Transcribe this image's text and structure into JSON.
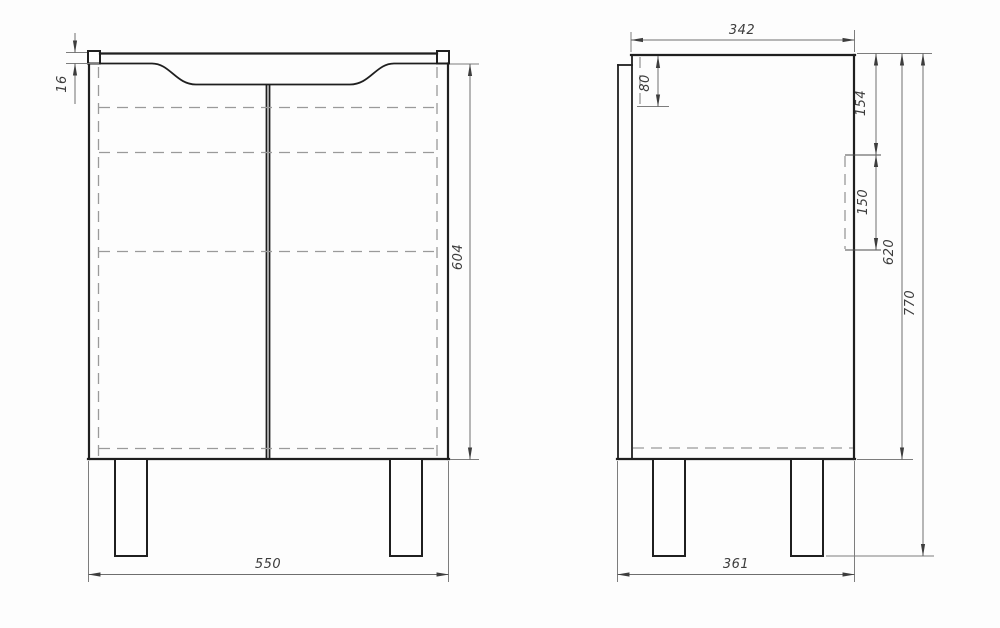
{
  "dims": {
    "front": {
      "top_thickness": "16",
      "height": "604",
      "width": "550"
    },
    "side": {
      "depth_top": "342",
      "apron_drop": "80",
      "upper_offset": "154",
      "cutout_height": "150",
      "carcass_height": "620",
      "total_height": "770",
      "depth_bottom": "361"
    }
  },
  "colors": {
    "outline": "#1f1f1f",
    "dimension": "#6e6e6e",
    "hidden_line": "#9a9a9a",
    "text": "#3d3d3d",
    "background": "#fdfdfd"
  }
}
